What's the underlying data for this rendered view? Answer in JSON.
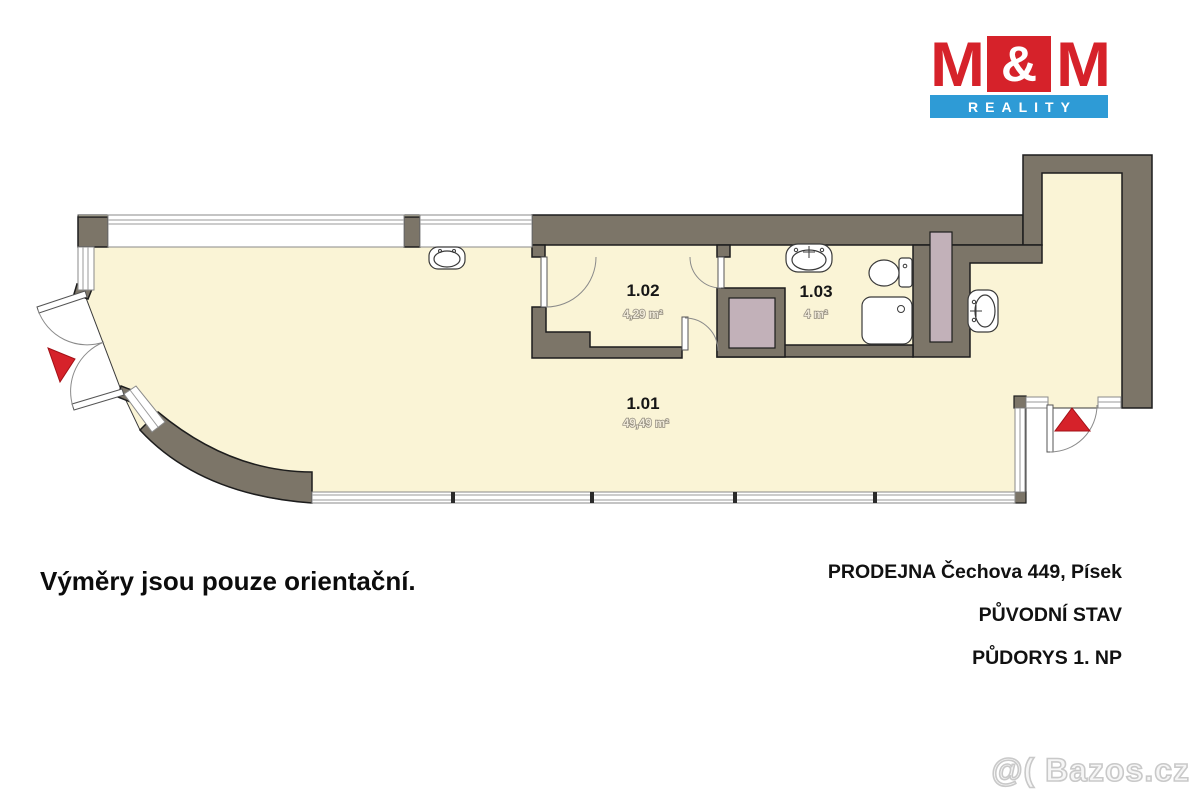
{
  "logo": {
    "m_left": "M",
    "ampersand": "&",
    "m_right": "M",
    "subtitle": "REALITY",
    "red": "#d6222a",
    "blue": "#2e9bd6"
  },
  "plan": {
    "wall_color": "#7c7568",
    "floor_color": "#faf4d6",
    "shaft_color": "#c2b1b9",
    "entrance_arrow_color": "#d6222a",
    "rooms": [
      {
        "number": "1.01",
        "area": "49,49 m²"
      },
      {
        "number": "1.02",
        "area": "4,29 m²"
      },
      {
        "number": "1.03",
        "area": "4 m²"
      }
    ]
  },
  "footer": {
    "disclaimer": "Výměry jsou pouze orientační.",
    "line1": "PRODEJNA Čechova 449, Písek",
    "line2": "PŮVODNÍ STAV",
    "line3": "PŮDORYS 1. NP"
  },
  "watermark": "@( Bazos.cz"
}
